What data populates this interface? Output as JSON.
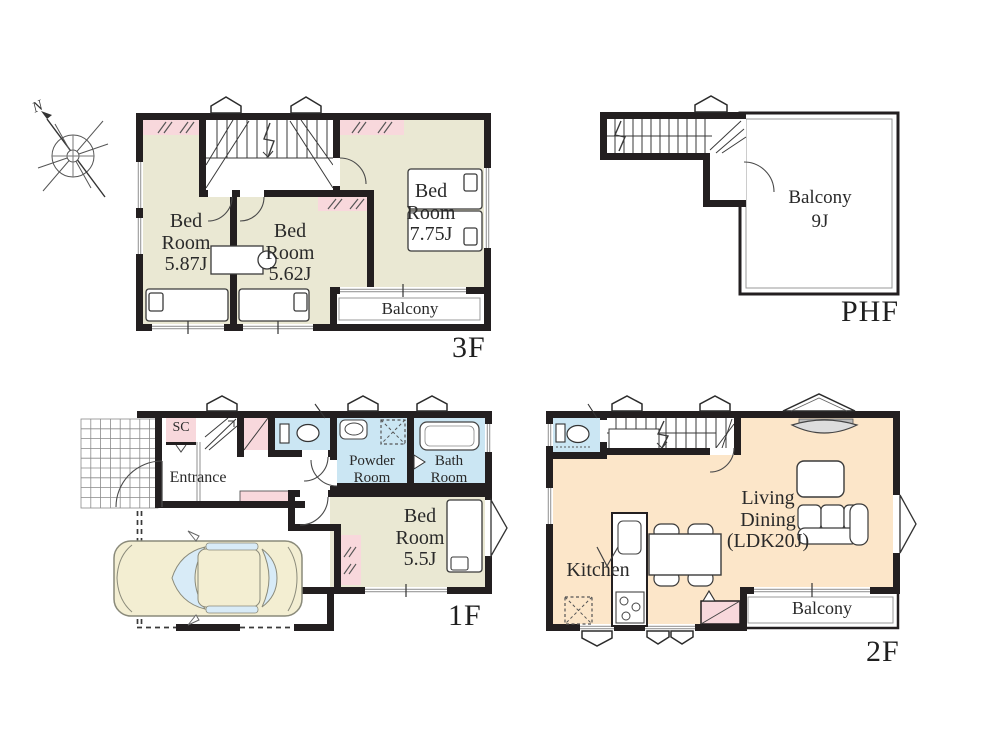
{
  "page": {
    "type": "real-estate-floor-plan",
    "background": "#ffffff"
  },
  "compass": {
    "label": "N"
  },
  "palette": {
    "wall": "#231f20",
    "room_beige": "#eae8d3",
    "room_peach": "#fce6c9",
    "room_blue": "#cbe6f3",
    "closet_pink": "#f8d8dc",
    "window_line": "#999999",
    "car_body": "#f3eed2",
    "car_glass": "#d8ebf7"
  },
  "floors": [
    {
      "id": "3f",
      "label": "3F",
      "rooms": [
        {
          "name": "bedroom-587",
          "lines": [
            "Bed",
            "Room",
            "5.87J"
          ]
        },
        {
          "name": "bedroom-562",
          "lines": [
            "Bed",
            "Room",
            "5.62J"
          ]
        },
        {
          "name": "bedroom-775",
          "lines": [
            "Bed",
            "Room",
            "7.75J"
          ]
        },
        {
          "name": "balcony",
          "lines": [
            "Balcony"
          ]
        }
      ]
    },
    {
      "id": "phf",
      "label": "PHF",
      "rooms": [
        {
          "name": "balcony-9j",
          "lines": [
            "Balcony",
            "9J"
          ]
        }
      ]
    },
    {
      "id": "1f",
      "label": "1F",
      "rooms": [
        {
          "name": "shoe-closet",
          "lines": [
            "SC"
          ]
        },
        {
          "name": "entrance",
          "lines": [
            "Entrance"
          ]
        },
        {
          "name": "powder-room",
          "lines": [
            "Powder",
            "Room"
          ]
        },
        {
          "name": "bath-room",
          "lines": [
            "Bath",
            "Room"
          ]
        },
        {
          "name": "bedroom-55",
          "lines": [
            "Bed",
            "Room",
            "5.5J"
          ]
        }
      ]
    },
    {
      "id": "2f",
      "label": "2F",
      "rooms": [
        {
          "name": "kitchen",
          "lines": [
            "Kitchen"
          ]
        },
        {
          "name": "living-dining",
          "lines": [
            "Living",
            "Dining",
            "(LDK20J)"
          ]
        },
        {
          "name": "balcony",
          "lines": [
            "Balcony"
          ]
        }
      ]
    }
  ]
}
